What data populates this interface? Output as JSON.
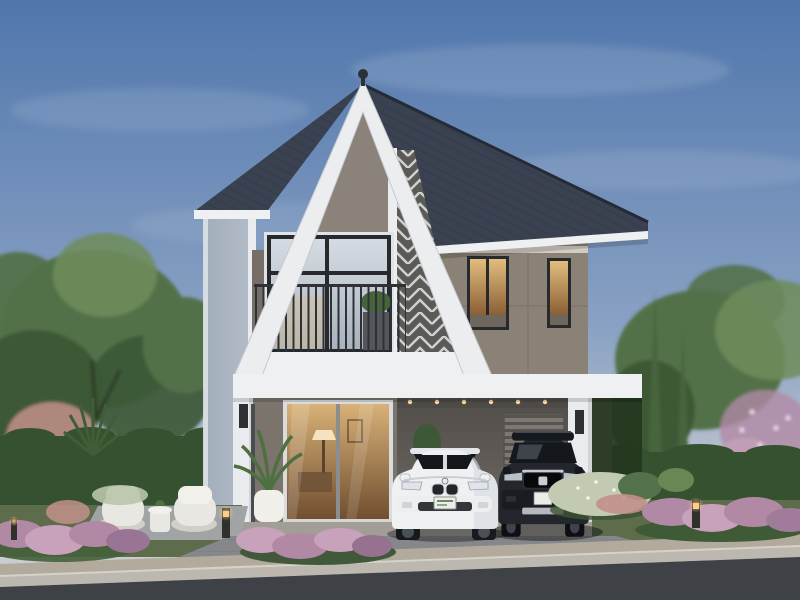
{
  "palette": {
    "sky_top": "#5076ac",
    "sky_mid": "#8aa2c4",
    "sky_horizon": "#c9ccd2",
    "cloud": "#ffffff",
    "roof": "#3a4150",
    "roof_edge": "#242a36",
    "fascia": "#eef0f2",
    "gable_frame": "#ecedef",
    "gable_panel": "#8b8279",
    "screen_bg": "#5b5a57",
    "screen_slat": "#dcdfe1",
    "wall_right": "#8a8177",
    "wall_ground": "#7a746d",
    "side_wall": "#b2bcc8",
    "carport_wall": "#6b6661",
    "carport_ceiling": "#4e4b47",
    "louver_panel": "#7e7872",
    "column": "#e9ebee",
    "window_frame": "#27292d",
    "glass_hi": "#d5dbe2",
    "glass_lo": "#a9b3bd",
    "glass_warm_hi": "#e2bd7d",
    "glass_warm_lo": "#8a5f36",
    "interior_hi": "#d8b177",
    "interior_lo": "#6e4c2e",
    "railing": "#2e3236",
    "sconce": "#2e3033",
    "tree_dark": "#3c5836",
    "tree_mid": "#53714a",
    "tree_light": "#6f8c5a",
    "hedge": "#36512f",
    "cypress": "#47653e",
    "flower_pink": "#b189a5",
    "flower_pink_light": "#c7a2ba",
    "flower_salmon": "#c2908a",
    "bush_white": "#c2cbb2",
    "grass": "#5d6c4a",
    "terrace": "#a0a4a5",
    "chair": "#e9e7e2",
    "chair_shade": "#d2cfc8",
    "pot": "#f0efea",
    "plant_green": "#4e7040",
    "driveway": "#85878b",
    "apron": "#b2aa9d",
    "curb": "#bcb8af",
    "road": "#3e4145",
    "car_white": "#eff0f2",
    "car_white_shade": "#d4d8dd",
    "car_dark": "#23272d",
    "car_glass": "#14171c",
    "chrome": "#c6cbd1",
    "plate": "#e9efe7",
    "bollard": "#31312c",
    "glow": "#ffcf86"
  }
}
